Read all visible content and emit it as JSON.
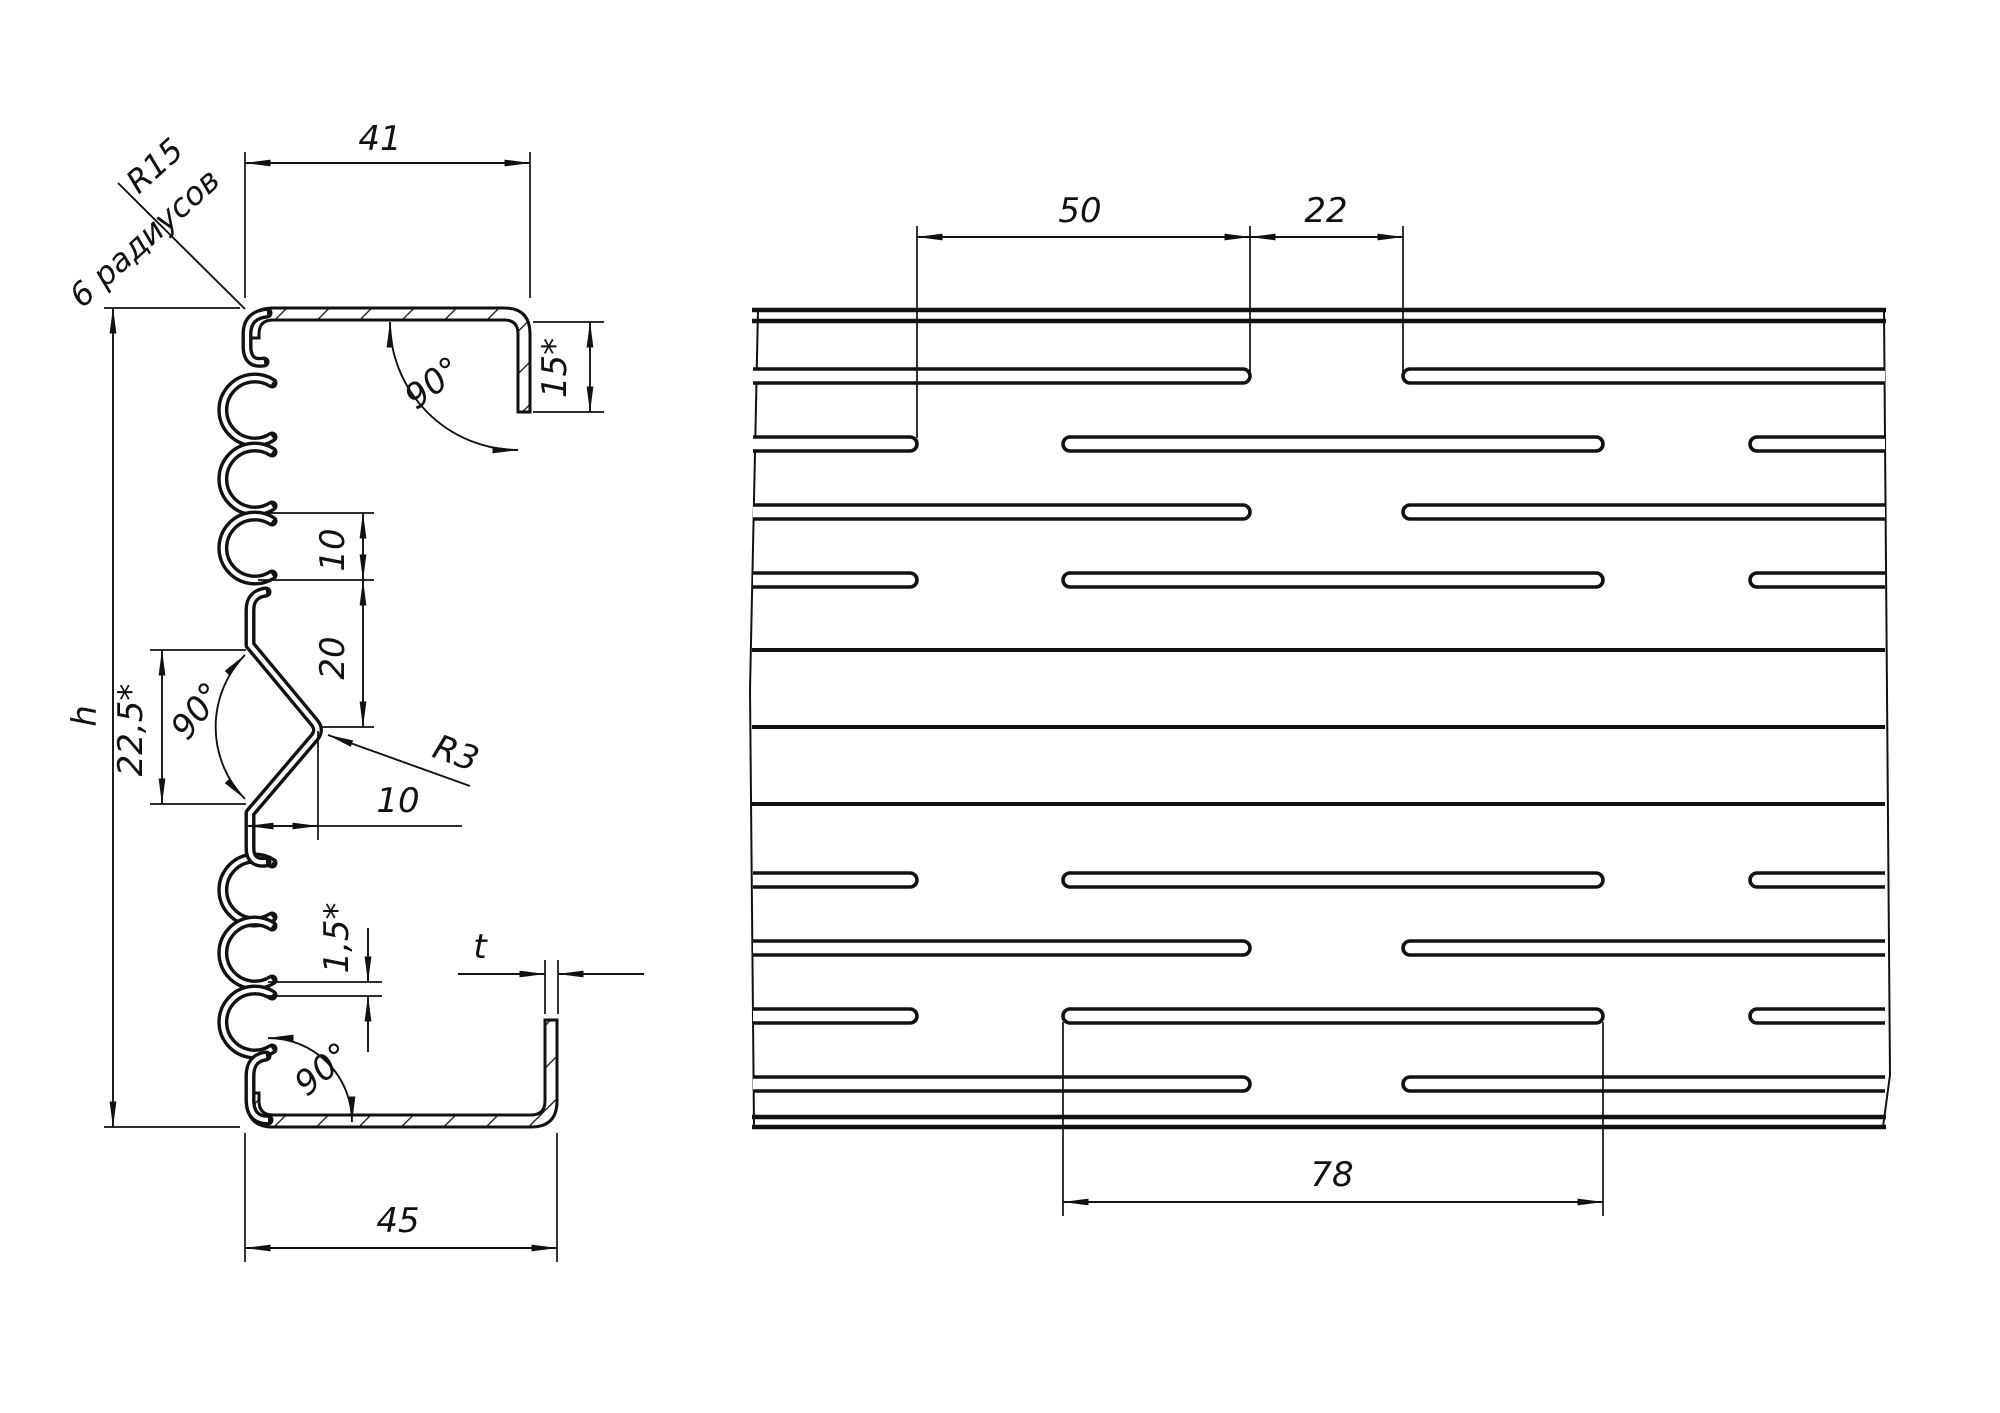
{
  "drawing": {
    "left_view": {
      "top_width": "41",
      "corner_radius_note": "R15",
      "radii_count_note": "6 радиусов",
      "top_angle": "90°",
      "lip_length": "15*",
      "height_label": "h",
      "bridge_height": "10",
      "rib_clearance": "20",
      "rib_span": "22,5*",
      "rib_angle": "90°",
      "rib_radius": "R3",
      "rib_depth": "10",
      "bottom_offset": "1,5*",
      "bottom_angle": "90°",
      "thickness_label": "t",
      "bottom_width": "45"
    },
    "right_view": {
      "row_stagger": "50",
      "slot_end_gap": "22",
      "slot_length": "78"
    }
  }
}
